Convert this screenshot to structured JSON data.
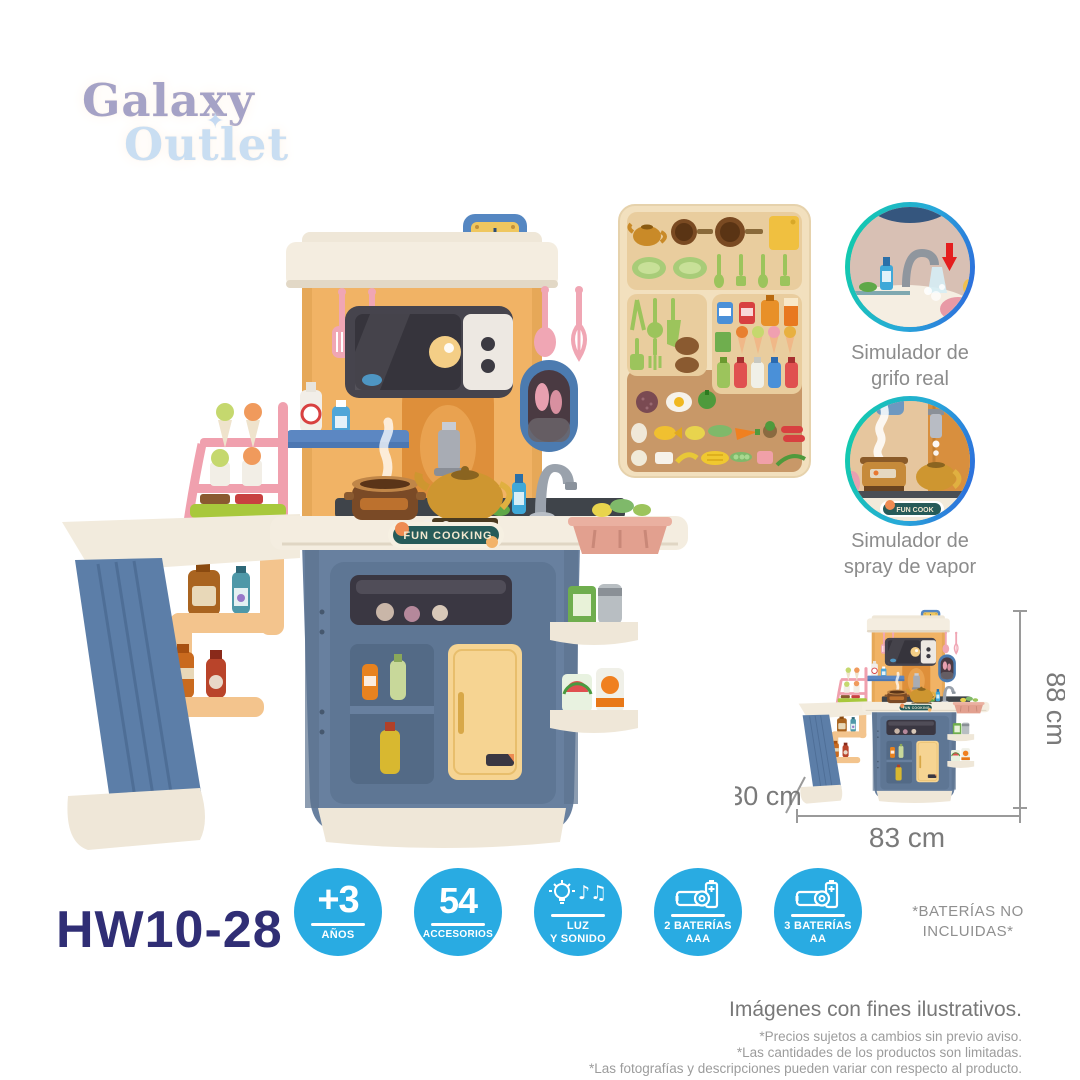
{
  "brand": {
    "word1": "Galaxy",
    "star": "✦",
    "word2": "Outlet"
  },
  "kitchen": {
    "label": "FUN COOKING",
    "mini_label": "FUN COOK"
  },
  "features": [
    {
      "line1": "Simulador de",
      "line2": "grifo real"
    },
    {
      "line1": "Simulador de",
      "line2": "spray de vapor"
    }
  ],
  "dimensions": {
    "height": "88 cm",
    "depth": "30 cm",
    "width": "83 cm"
  },
  "model": "HW10-28",
  "badges": [
    {
      "value": "+3",
      "line1": "AÑOS",
      "line2": ""
    },
    {
      "value": "54",
      "line1": "ACCESORIOS",
      "line2": ""
    },
    {
      "icon": "light-and-music",
      "line1": "LUZ",
      "line2": "Y SONIDO",
      "notes_glyphs": "♪♫"
    },
    {
      "icon": "batteries",
      "line1": "2 BATERÍAS",
      "line2": "AAA"
    },
    {
      "icon": "batteries",
      "line1": "3 BATERÍAS",
      "line2": "AA"
    }
  ],
  "battery_note": {
    "line1": "*BATERÍAS NO",
    "line2": "INCLUIDAS*"
  },
  "disclaimer": {
    "title": "Imágenes con fines ilustrativos.",
    "line1": "*Precios sujetos a cambios sin previo aviso.",
    "line2": "*Las cantidades de los productos son limitadas.",
    "line3": "*Las fotografías y descripciones pueden variar  con respecto al producto."
  },
  "colors": {
    "badge_blue": "#29ABE2",
    "model_navy": "#302E75",
    "ring_teal": "#0FD0A6",
    "ring_blue": "#2E62DC",
    "caption_gray": "#8C8C8C"
  }
}
